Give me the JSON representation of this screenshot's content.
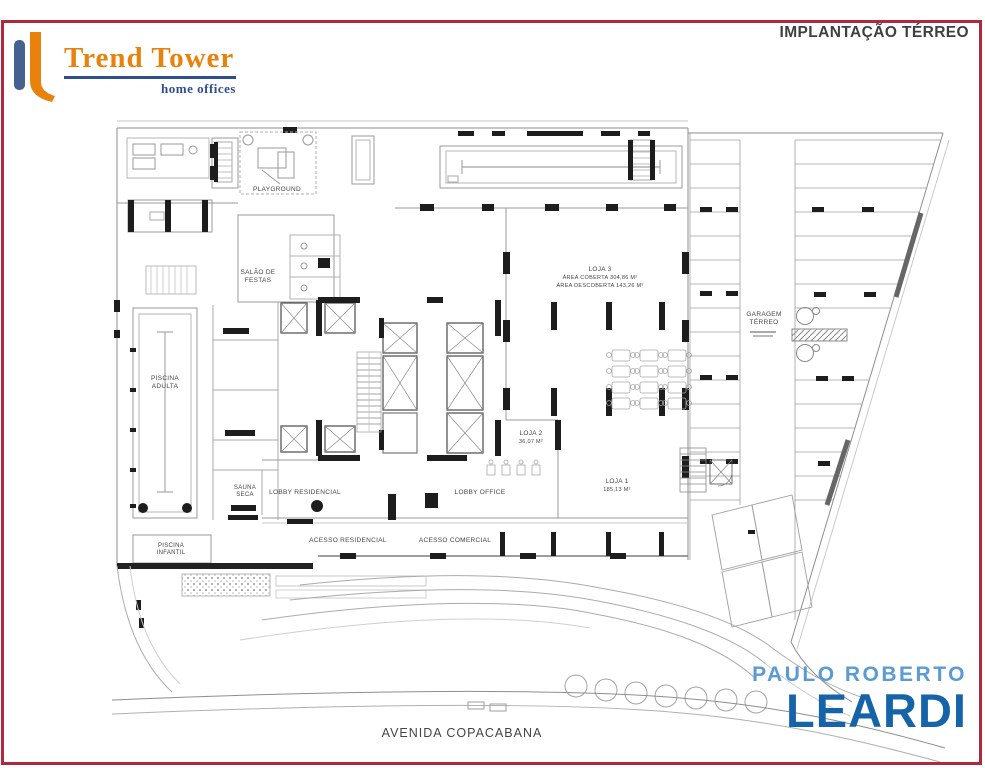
{
  "header": {
    "title": "IMPLANTAÇÃO TÉRREO",
    "logo": {
      "name": "Trend Tower",
      "tagline": "home offices",
      "orange": "#e8820c",
      "blue": "#2d4f8f"
    }
  },
  "plan": {
    "labels": {
      "playground": "PLAYGROUND",
      "salao_1": "SALÃO DE",
      "salao_2": "FESTAS",
      "piscina_adulta_1": "PISCINA",
      "piscina_adulta_2": "ADULTA",
      "piscina_infantil_1": "PISCINA",
      "piscina_infantil_2": "INFANTIL",
      "sauna_1": "SAUNA",
      "sauna_2": "SECA",
      "lobby_residencial": "LOBBY RESIDENCIAL",
      "lobby_office": "LOBBY OFFICE",
      "acesso_residencial": "ACESSO RESIDENCIAL",
      "acesso_comercial": "ACESSO COMERCIAL",
      "loja3_1": "LOJA 3",
      "loja3_2": "ÁREA COBERTA 304,86 M²",
      "loja3_3": "ÁREA DESCOBERTA 143,26 M²",
      "loja2_1": "LOJA 2",
      "loja2_2": "36,07 M²",
      "loja1_1": "LOJA 1",
      "loja1_2": "185,13 M²",
      "garagem_1": "GARAGEM",
      "garagem_2": "TÉRREO"
    },
    "street": "AVENIDA COPACABANA"
  },
  "broker": {
    "line1": "PAULO ROBERTO",
    "line2": "LEARDI",
    "light_blue": "#5b9bd5",
    "dark_blue": "#1563a8"
  },
  "frame_color": "#b02740"
}
